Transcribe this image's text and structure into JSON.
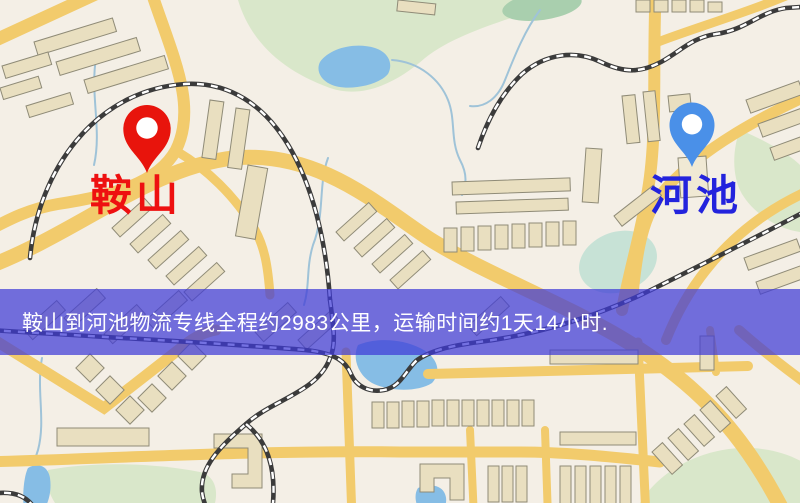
{
  "map": {
    "kind": "road-map",
    "colors": {
      "background": "#f4efe6",
      "road": "#f2cb6c",
      "water": "#86bde5",
      "park": "#d9e7ca",
      "building": "#e9dfc0",
      "railway": "#3b3b3b"
    }
  },
  "origin": {
    "name": "鞍山",
    "label_color": "#ee1010",
    "pin_color": "#e8140c",
    "pin_icon": "red-location-pin"
  },
  "destination": {
    "name": "河池",
    "label_color": "#2323dd",
    "pin_color": "#4a90e8",
    "pin_icon": "blue-location-pin"
  },
  "banner": {
    "text": "鞍山到河池物流专线全程约2983公里，运输时间约1天14小时.",
    "background": "rgba(62,58,215,0.72)",
    "text_color": "#ffffff",
    "route": {
      "origin": "鞍山",
      "destination": "河池",
      "distance": "约2983公里",
      "duration": "约1天14小时"
    }
  }
}
